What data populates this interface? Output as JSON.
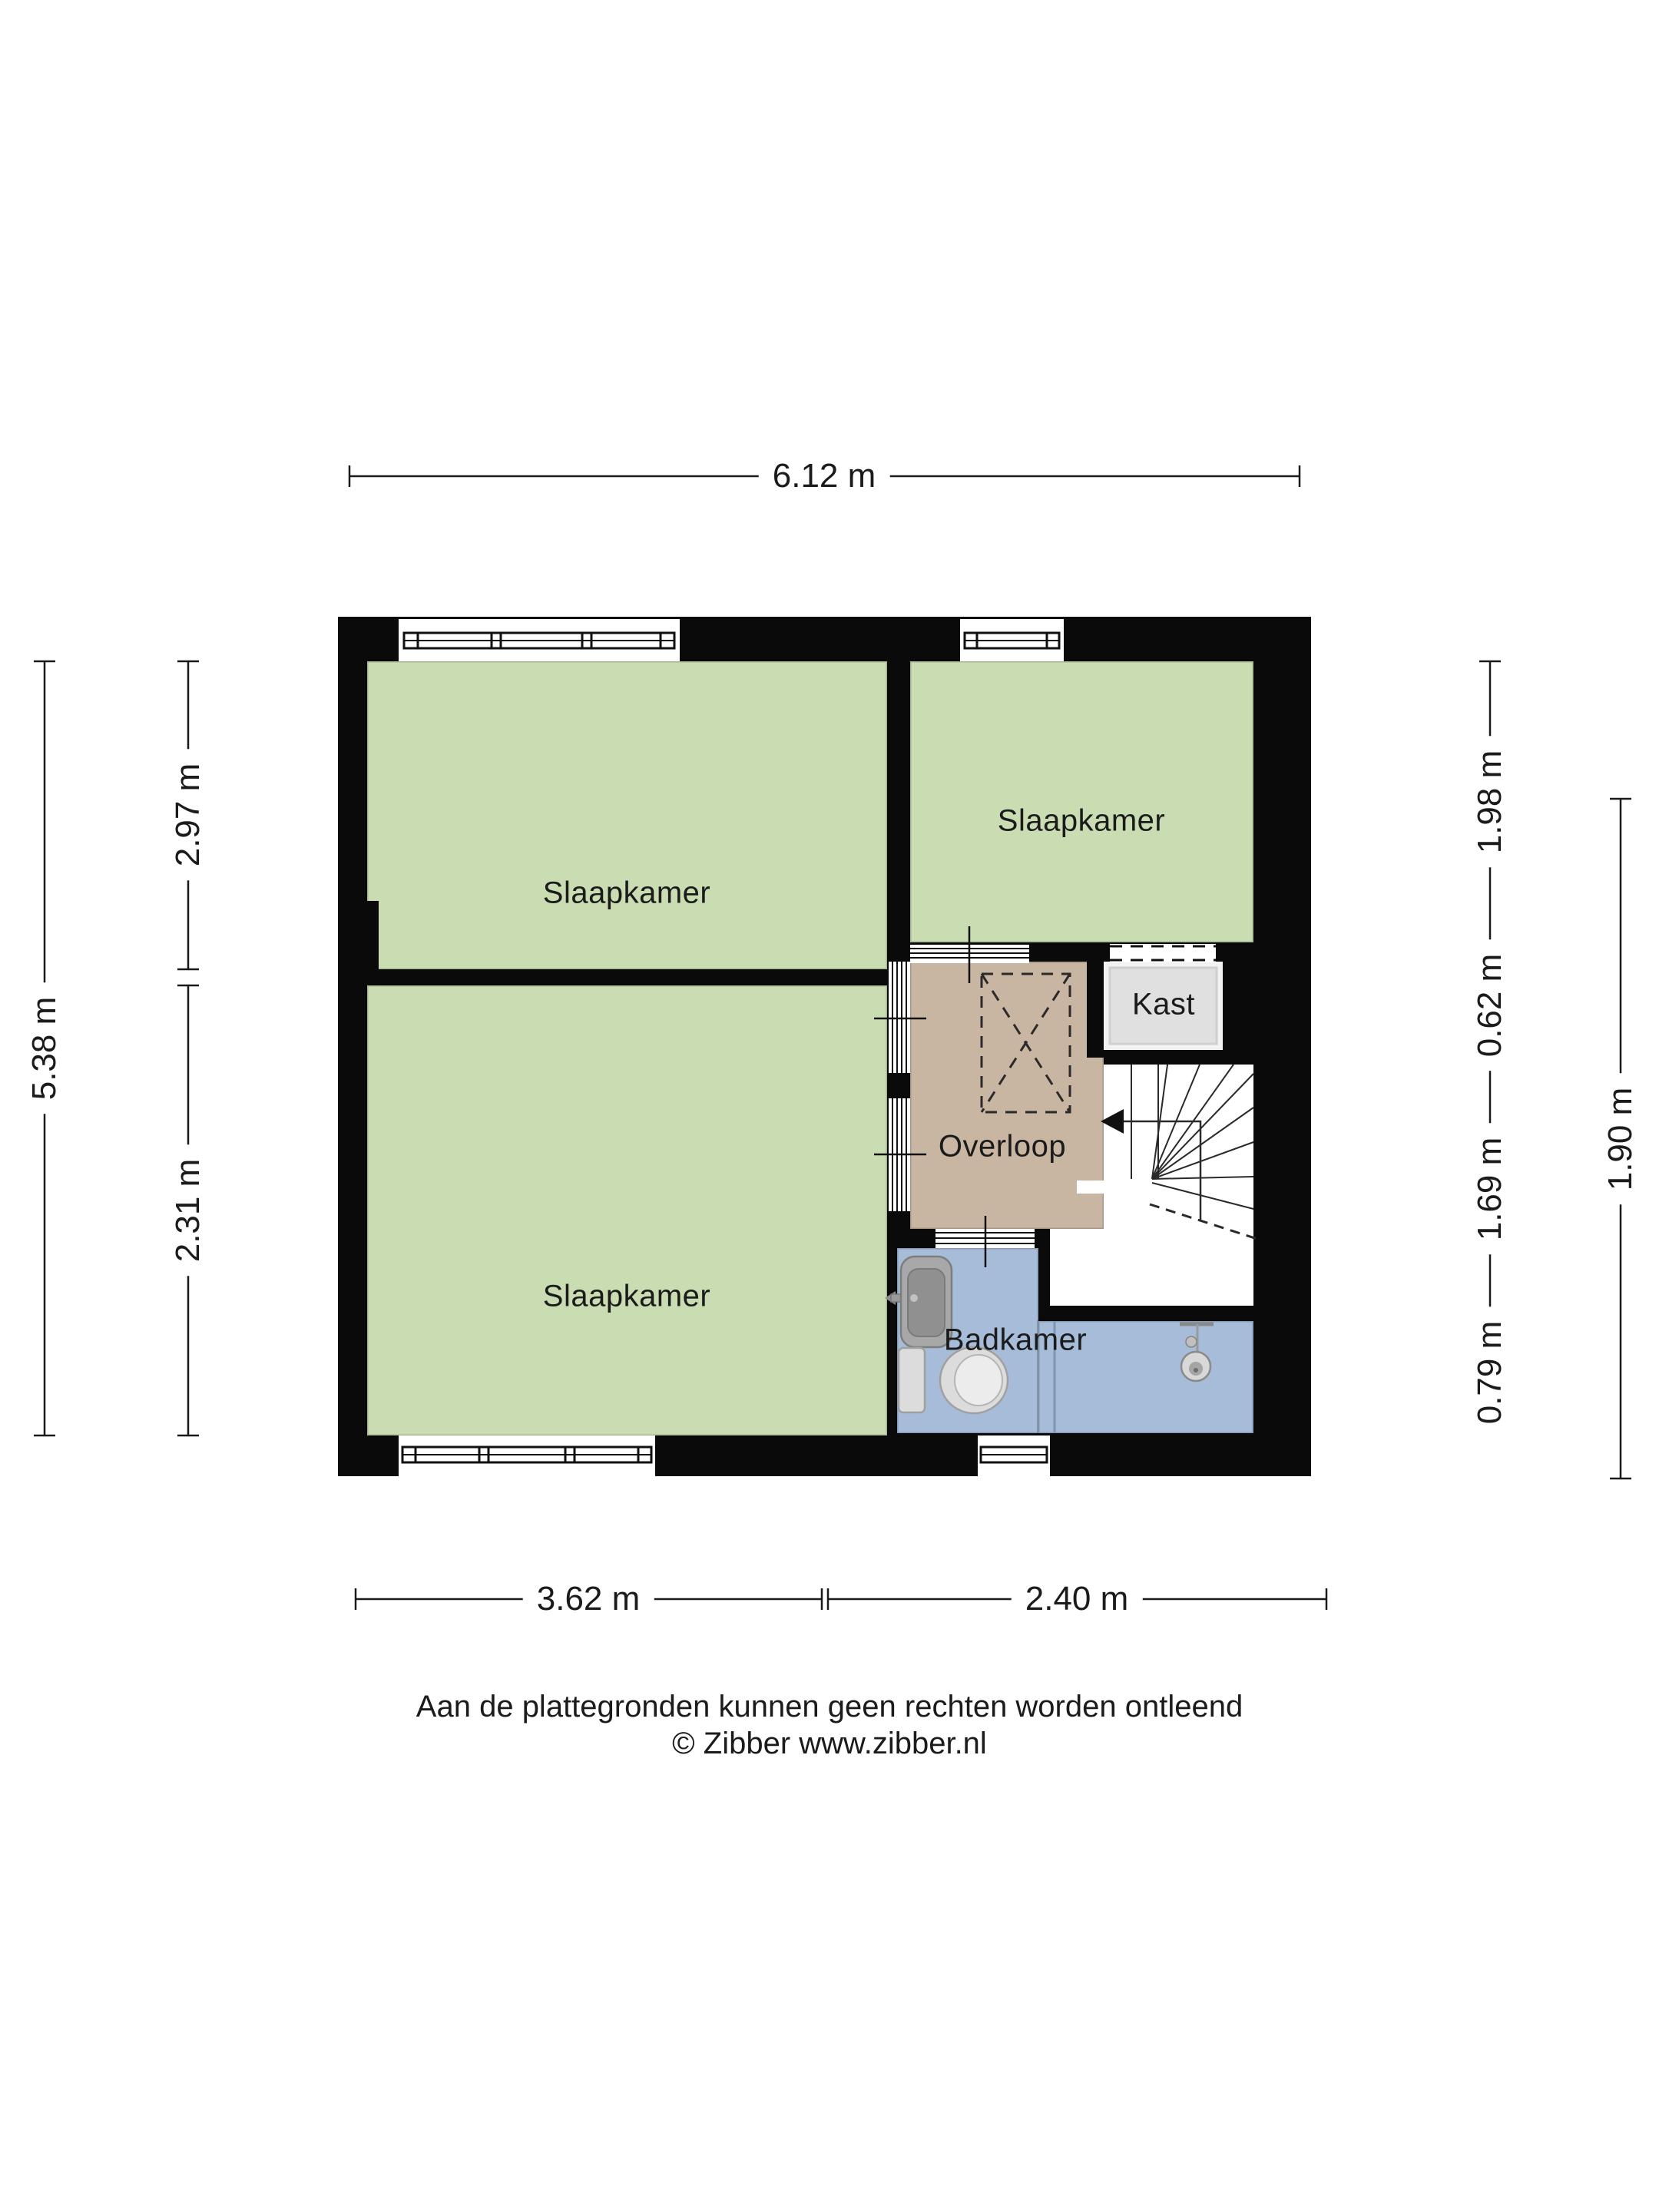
{
  "floorplan": {
    "rooms": [
      {
        "id": "bedroom-top-left",
        "label": "Slaapkamer"
      },
      {
        "id": "bedroom-top-right",
        "label": "Slaapkamer"
      },
      {
        "id": "bedroom-bottom-left",
        "label": "Slaapkamer"
      },
      {
        "id": "closet",
        "label": "Kast"
      },
      {
        "id": "landing",
        "label": "Overloop"
      },
      {
        "id": "bathroom",
        "label": "Badkamer"
      }
    ],
    "colors": {
      "room_green": "#cadcb2",
      "hall_tan": "#c9b6a2",
      "bath_blue": "#a6bcd8",
      "closet_gray": "#e0e0e0",
      "wall_black": "#0a0a0a"
    },
    "dimensions": {
      "top": "6.12 m",
      "left_outer": "5.38 m",
      "left_inner_top": "2.97 m",
      "left_inner_bottom": "2.31 m",
      "right_inner": [
        "1.98 m",
        "0.62 m",
        "1.69 m",
        "0.79 m"
      ],
      "right_outer": "1.90 m",
      "bottom_left": "3.62 m",
      "bottom_right": "2.40 m"
    },
    "footer_line1": "Aan de plattegronden kunnen geen rechten worden ontleend",
    "footer_line2": "© Zibber www.zibber.nl"
  }
}
